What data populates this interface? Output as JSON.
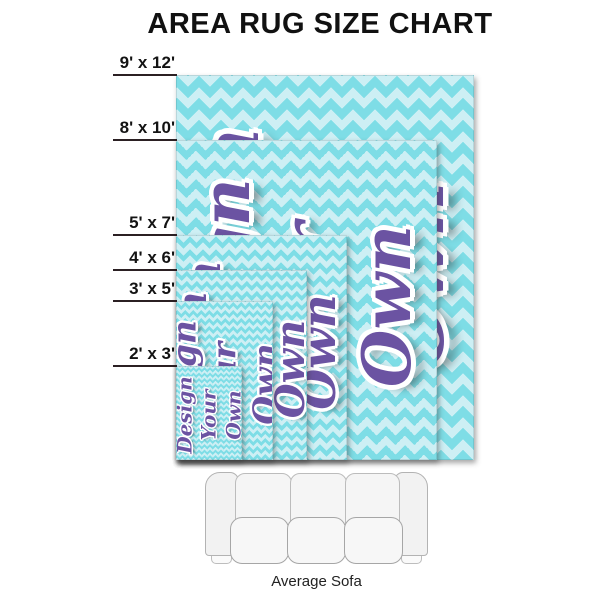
{
  "title": "AREA RUG SIZE CHART",
  "rug_design_text": {
    "lines": [
      "Design",
      "Your",
      "Own"
    ]
  },
  "sofa": {
    "label": "Average Sofa"
  },
  "colors": {
    "chevron_base": "#7edde6",
    "chevron_light": "#cdeff4",
    "design_text_purple": "#6b53a2",
    "size_line": "#2b2023",
    "size_label": "#131313"
  },
  "rugs": [
    {
      "id": "9x12",
      "label": "9' x 12'",
      "width_ft": 9,
      "length_ft": 12,
      "left": 176,
      "top": 75,
      "width": 298,
      "height": 385,
      "font_px": 76,
      "chevron_px": 22
    },
    {
      "id": "8x10",
      "label": "8' x 10'",
      "width_ft": 8,
      "length_ft": 10,
      "left": 176,
      "top": 140,
      "width": 261,
      "height": 320,
      "font_px": 66,
      "chevron_px": 19
    },
    {
      "id": "5x7",
      "label": "5' x 7'",
      "width_ft": 5,
      "length_ft": 7,
      "left": 176,
      "top": 235,
      "width": 171,
      "height": 225,
      "font_px": 47,
      "chevron_px": 13
    },
    {
      "id": "4x6",
      "label": "4' x 6'",
      "width_ft": 4,
      "length_ft": 6,
      "left": 176,
      "top": 270,
      "width": 131,
      "height": 190,
      "font_px": 40,
      "chevron_px": 10
    },
    {
      "id": "3x5",
      "label": "3' x 5'",
      "width_ft": 3,
      "length_ft": 5,
      "left": 176,
      "top": 301,
      "width": 97,
      "height": 159,
      "font_px": 33,
      "chevron_px": 8
    },
    {
      "id": "2x3",
      "label": "2' x 3'",
      "width_ft": 2,
      "length_ft": 3,
      "left": 176,
      "top": 366,
      "width": 66,
      "height": 94,
      "font_px": 20,
      "chevron_px": 5.5
    }
  ]
}
